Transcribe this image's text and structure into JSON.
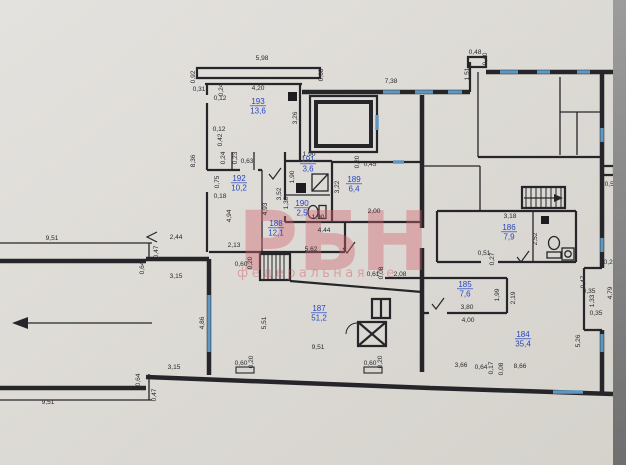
{
  "watermark": {
    "line1": "РБН",
    "line2": "федеральная се"
  },
  "colors": {
    "paper": "#dcd9d4",
    "wall": "#26262a",
    "window": "#5e97c2",
    "room_label": "#2544c0",
    "dimension_text": "#2b2b30",
    "watermark_pink": "#d4626e",
    "photo_edge_gray": "#8a8a8a"
  },
  "rooms": [
    {
      "number": "193",
      "area": "13,6",
      "x": 258,
      "y": 104
    },
    {
      "number": "192",
      "area": "10,2",
      "x": 239,
      "y": 181
    },
    {
      "number": "191",
      "area": "3,6",
      "x": 308,
      "y": 162
    },
    {
      "number": "190",
      "area": "2,5",
      "x": 302,
      "y": 206
    },
    {
      "number": "189",
      "area": "6,4",
      "x": 354,
      "y": 182
    },
    {
      "number": "188",
      "area": "12,1",
      "x": 276,
      "y": 226
    },
    {
      "number": "187",
      "area": "51,2",
      "x": 319,
      "y": 311
    },
    {
      "number": "186",
      "area": "7,9",
      "x": 509,
      "y": 230
    },
    {
      "number": "185",
      "area": "7,6",
      "x": 465,
      "y": 287
    },
    {
      "number": "184",
      "area": "35,4",
      "x": 523,
      "y": 337
    }
  ],
  "dimensions": [
    {
      "text": "5,98",
      "x": 262,
      "y": 60,
      "rot": 0
    },
    {
      "text": "0,92",
      "x": 195,
      "y": 77,
      "rot": 1
    },
    {
      "text": "0,31",
      "x": 199,
      "y": 91,
      "rot": 0
    },
    {
      "text": "0,24",
      "x": 223,
      "y": 90,
      "rot": 1
    },
    {
      "text": "4,20",
      "x": 258,
      "y": 90,
      "rot": 0
    },
    {
      "text": "0,12",
      "x": 220,
      "y": 100,
      "rot": 0
    },
    {
      "text": "0,68",
      "x": 323,
      "y": 75,
      "rot": 1
    },
    {
      "text": "7,38",
      "x": 391,
      "y": 83,
      "rot": 0
    },
    {
      "text": "3,26",
      "x": 297,
      "y": 118,
      "rot": 1
    },
    {
      "text": "0,12",
      "x": 219,
      "y": 131,
      "rot": 0
    },
    {
      "text": "0,42",
      "x": 222,
      "y": 140,
      "rot": 1
    },
    {
      "text": "8,36",
      "x": 195,
      "y": 161,
      "rot": 1
    },
    {
      "text": "0,24",
      "x": 225,
      "y": 158,
      "rot": 1
    },
    {
      "text": "0,23",
      "x": 237,
      "y": 158,
      "rot": 1
    },
    {
      "text": "0,63",
      "x": 247,
      "y": 163,
      "rot": 0
    },
    {
      "text": "0,75",
      "x": 219,
      "y": 182,
      "rot": 1
    },
    {
      "text": "0,18",
      "x": 220,
      "y": 198,
      "rot": 0
    },
    {
      "text": "4,94",
      "x": 231,
      "y": 216,
      "rot": 1
    },
    {
      "text": "2,13",
      "x": 234,
      "y": 247,
      "rot": 0
    },
    {
      "text": "1,90",
      "x": 309,
      "y": 156,
      "rot": 0
    },
    {
      "text": "1,90",
      "x": 294,
      "y": 177,
      "rot": 1
    },
    {
      "text": "3,52",
      "x": 281,
      "y": 194,
      "rot": 1
    },
    {
      "text": "4,93",
      "x": 267,
      "y": 209,
      "rot": 1
    },
    {
      "text": "1,30",
      "x": 288,
      "y": 203,
      "rot": 1
    },
    {
      "text": "1,90",
      "x": 318,
      "y": 219,
      "rot": 0
    },
    {
      "text": "0,20",
      "x": 359,
      "y": 162,
      "rot": 1
    },
    {
      "text": "0,45",
      "x": 370,
      "y": 166,
      "rot": 0
    },
    {
      "text": "3,22",
      "x": 339,
      "y": 187,
      "rot": 1
    },
    {
      "text": "2,00",
      "x": 374,
      "y": 213,
      "rot": 0
    },
    {
      "text": "4,44",
      "x": 324,
      "y": 232,
      "rot": 0
    },
    {
      "text": "5,62",
      "x": 311,
      "y": 251,
      "rot": 0
    },
    {
      "text": "9,51",
      "x": 52,
      "y": 240,
      "rot": 0
    },
    {
      "text": "2,44",
      "x": 176,
      "y": 239,
      "rot": 0
    },
    {
      "text": "0,47",
      "x": 158,
      "y": 252,
      "rot": 1
    },
    {
      "text": "0,64",
      "x": 144,
      "y": 268,
      "rot": 1
    },
    {
      "text": "3,15",
      "x": 176,
      "y": 278,
      "rot": 0
    },
    {
      "text": "4,86",
      "x": 204,
      "y": 323,
      "rot": 1
    },
    {
      "text": "3,15",
      "x": 174,
      "y": 369,
      "rot": 0
    },
    {
      "text": "0,64",
      "x": 140,
      "y": 380,
      "rot": 1
    },
    {
      "text": "0,47",
      "x": 156,
      "y": 395,
      "rot": 1
    },
    {
      "text": "9,51",
      "x": 48,
      "y": 404,
      "rot": 0
    },
    {
      "text": "5,51",
      "x": 266,
      "y": 323,
      "rot": 1
    },
    {
      "text": "9,51",
      "x": 318,
      "y": 349,
      "rot": 0
    },
    {
      "text": "0,60",
      "x": 241,
      "y": 365,
      "rot": 0
    },
    {
      "text": "0,20",
      "x": 253,
      "y": 362,
      "rot": 1
    },
    {
      "text": "0,60",
      "x": 370,
      "y": 365,
      "rot": 0
    },
    {
      "text": "0,20",
      "x": 382,
      "y": 362,
      "rot": 1
    },
    {
      "text": "0,60",
      "x": 241,
      "y": 266,
      "rot": 0
    },
    {
      "text": "0,20",
      "x": 252,
      "y": 263,
      "rot": 1
    },
    {
      "text": "0,61",
      "x": 373,
      "y": 276,
      "rot": 0
    },
    {
      "text": "0,08",
      "x": 383,
      "y": 273,
      "rot": 1
    },
    {
      "text": "2,08",
      "x": 400,
      "y": 276,
      "rot": 0
    },
    {
      "text": "0,48",
      "x": 475,
      "y": 54,
      "rot": 0
    },
    {
      "text": "0,40",
      "x": 487,
      "y": 59,
      "rot": 1
    },
    {
      "text": "1,51",
      "x": 469,
      "y": 74,
      "rot": 1
    },
    {
      "text": "0,56",
      "x": 611,
      "y": 186,
      "rot": 0
    },
    {
      "text": "3,18",
      "x": 510,
      "y": 218,
      "rot": 0
    },
    {
      "text": "2,52",
      "x": 537,
      "y": 239,
      "rot": 1
    },
    {
      "text": "0,51",
      "x": 484,
      "y": 255,
      "rot": 0
    },
    {
      "text": "0,27",
      "x": 494,
      "y": 259,
      "rot": 1
    },
    {
      "text": "0,20",
      "x": 610,
      "y": 264,
      "rot": 0
    },
    {
      "text": "0,47",
      "x": 585,
      "y": 282,
      "rot": 1
    },
    {
      "text": "0,35",
      "x": 589,
      "y": 293,
      "rot": 0
    },
    {
      "text": "1,33",
      "x": 594,
      "y": 301,
      "rot": 1
    },
    {
      "text": "0,35",
      "x": 596,
      "y": 315,
      "rot": 0
    },
    {
      "text": "4,79",
      "x": 612,
      "y": 293,
      "rot": 1
    },
    {
      "text": "5,26",
      "x": 580,
      "y": 341,
      "rot": 1
    },
    {
      "text": "1,99",
      "x": 499,
      "y": 295,
      "rot": 1
    },
    {
      "text": "2,19",
      "x": 515,
      "y": 298,
      "rot": 1
    },
    {
      "text": "3,80",
      "x": 467,
      "y": 309,
      "rot": 0
    },
    {
      "text": "4,00",
      "x": 468,
      "y": 322,
      "rot": 0
    },
    {
      "text": "3,66",
      "x": 461,
      "y": 367,
      "rot": 0
    },
    {
      "text": "0,64",
      "x": 481,
      "y": 369,
      "rot": 0
    },
    {
      "text": "0,17",
      "x": 493,
      "y": 368,
      "rot": 1
    },
    {
      "text": "0,08",
      "x": 503,
      "y": 369,
      "rot": 1
    },
    {
      "text": "8,66",
      "x": 520,
      "y": 368,
      "rot": 0
    }
  ]
}
